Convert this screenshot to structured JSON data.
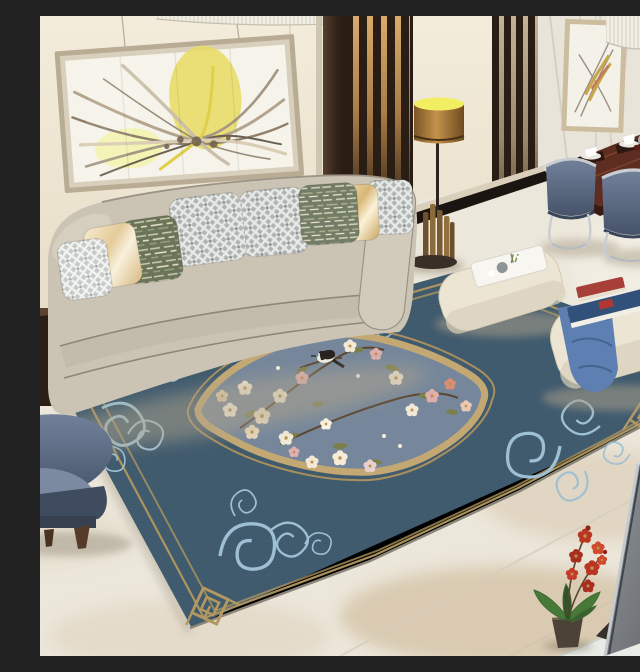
{
  "meta": {
    "kind": "interior-photograph",
    "description": "Modern Chinese-style living room with a large blue floral-medallion area rug",
    "width": 640,
    "height": 640,
    "no_visible_text": true
  },
  "palette": {
    "wall": "#eee6d3",
    "floor": "#ece7db",
    "floor_mottle": "#cdb795",
    "baseboard": "#d9cfba",
    "inlay_black": "#1a1510",
    "rug_main": "#3f5a6d",
    "rug_field_light": "#76879b",
    "rug_gold": "#b3985f",
    "rug_scroll_blue": "#9ec0d2",
    "rug_fringe": "#cfcaba",
    "medallion_band": "#c3a873",
    "sofa": "#cbc4b5",
    "sofa_shadow": "#c3bcad",
    "sofa_piping": "#8d8679",
    "pillow_lattice_gray": "#aeb4b2",
    "pillow_lattice_silver": "#c6cac8",
    "pillow_green": "#6b7459",
    "pillow_cream": "#f2e7c9",
    "pillow_gold": "#ecd6a0",
    "divider_wood": "#2a1d13",
    "divider_glow": "#cc9f63",
    "dark_bar": "#3a2a1f",
    "marble_wall": "#e9e4da",
    "mirror_column": "#241c12",
    "mirror_gold": "#8a6f42",
    "frame_art": "#b9ac94",
    "art_yellow": "#e4d44e",
    "lamp_shade": "#a87f3e",
    "lamp_glow": "#f2ee62",
    "lamp_base": "#7c5c33",
    "dining_table": "#5c2d20",
    "chair_velvet": "#5f7693",
    "chair_velvet_light": "#8aa3bd",
    "chair_chrome": "#c9cdd2",
    "ottoman": "#ece5d3",
    "throw_blue": "#5d7fb2",
    "book_blue": "#31517a",
    "book_red": "#a8403a",
    "armchair": "#5e6d82",
    "armchair_dark": "#3f4b5e",
    "wood_leg": "#573b2a",
    "tv_gray": "#7d8287",
    "tv_stand": "#35302c",
    "tv_plinth": "#e9ebe7",
    "orchid_red": "#bb3520",
    "orchid_leaf": "#3f6a33",
    "pot": "#4d4238",
    "blossom_cream": "#f1e8d6",
    "blossom_pink": "#dfaeae",
    "blossom_peach": "#d98d72",
    "leaf_olive": "#7b7f49",
    "branch": "#5a4530",
    "bird_black": "#262220",
    "bird_white": "#f2efe6",
    "side_table": "#2a1e15",
    "chandelier": "#f1eee4"
  },
  "scene": {
    "objects": [
      {
        "name": "abstract-wall-art",
        "note": "framed abstract print, yellow and taupe strokes"
      },
      {
        "name": "ceiling-crystal-fringe",
        "note": "white crystal chandelier edge at top"
      },
      {
        "name": "wood-slat-dividers",
        "note": "dark brown vertical slat screens, warm backlight"
      },
      {
        "name": "marble-wall-panel-with-art",
        "note": "gold abstract art on marble wall"
      },
      {
        "name": "mirror-gold-column",
        "note": "dark mirrored column with brass lines"
      },
      {
        "name": "floor-lamp",
        "note": "brass cylinder shade, glowing top, organ-pipe base"
      },
      {
        "name": "dining-set",
        "note": "dark wood table, white napkins, blue velvet chairs, chrome legs"
      },
      {
        "name": "pink-table-flowers",
        "note": "pink orchid arrangement at right edge"
      },
      {
        "name": "curved-beige-sofa",
        "note": "eight pillows: gray lattice, green streak, cream and gold satin"
      },
      {
        "name": "side-table",
        "note": "dark wood cube at left edge"
      },
      {
        "name": "blue-floral-rug",
        "note": "navy rug, gold fret borders, light-blue cloud scrolls, quatrefoil medallion with cherry blossoms and magpie"
      },
      {
        "name": "ottoman-with-tray",
        "note": "cream pouf, white tray, teapot and sprig"
      },
      {
        "name": "ottoman-with-books",
        "note": "cream pouf, blue throw, red and blue books"
      },
      {
        "name": "blue-armchair",
        "note": "slate-blue armchair, wooden legs, bottom left"
      },
      {
        "name": "tv-back",
        "note": "gray television rear panel on white plinth, bottom right"
      },
      {
        "name": "red-orchid-plant",
        "note": "red orchid in dark pot"
      }
    ]
  }
}
